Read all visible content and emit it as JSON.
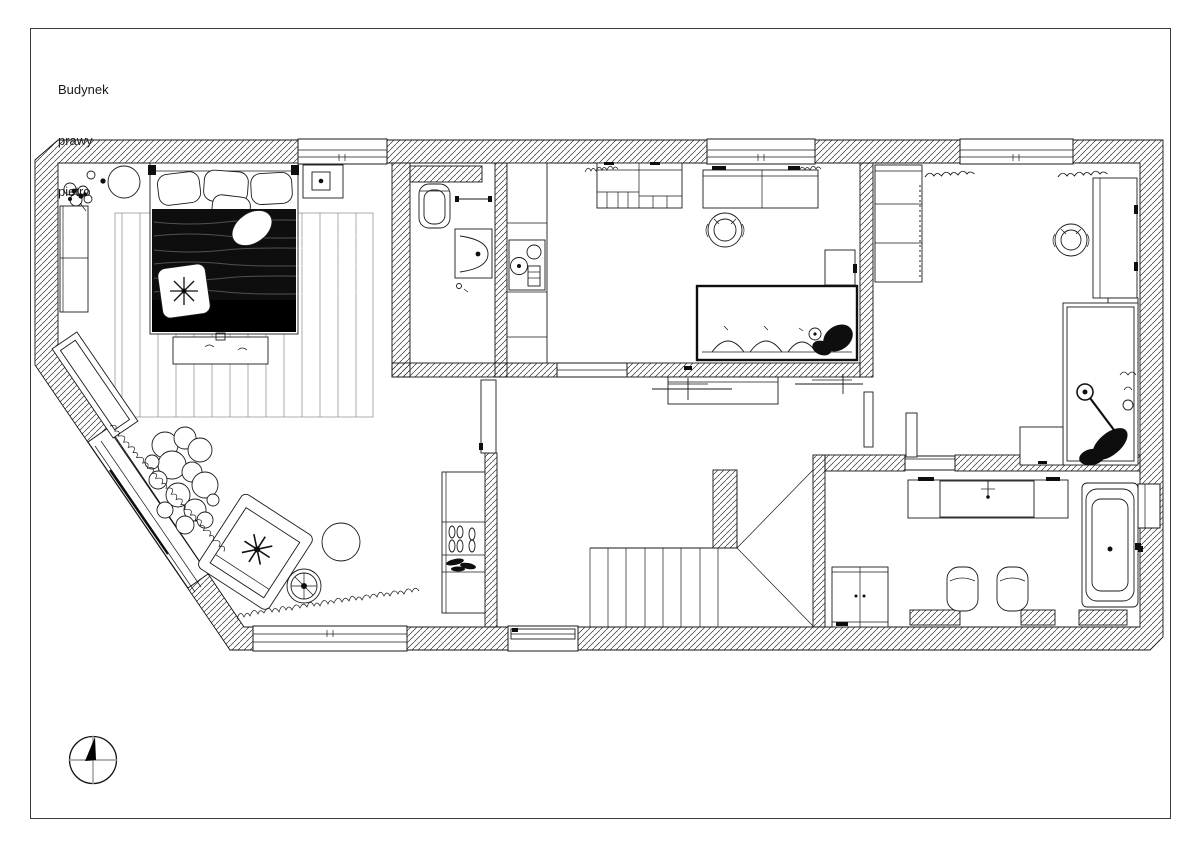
{
  "document": {
    "title_lines": [
      "Budynek",
      "prawy",
      "pietro"
    ]
  },
  "drawing": {
    "paper_color": "#ffffff",
    "line_color": "#1a1a1a",
    "wall_hatch": "diagonal-lines"
  },
  "compass": {
    "name": "north-arrow"
  },
  "plan_elements": [
    "double-bed",
    "bed-pillows",
    "duvet",
    "star-pillow",
    "rug",
    "bench",
    "nightstand-lamp",
    "wardrobe",
    "sideboard",
    "armchair",
    "round-table",
    "wheel-table",
    "plant-cluster",
    "grass-edge",
    "toilet",
    "washbasin",
    "towel-rail",
    "kitchenette-counter",
    "hob",
    "shelving-unit",
    "desk",
    "office-chair",
    "sofa",
    "sofa-cushions",
    "side-cabinet",
    "wardrobe-2",
    "desk-2",
    "office-chair-2",
    "lounger",
    "floor-lamp",
    "small-table",
    "stairs",
    "stairwell-void",
    "shoe-rack",
    "hall-cabinet",
    "hall-door",
    "sliding-door",
    "vanity-basin",
    "bathtub",
    "bathroom-cabinet",
    "stool-left",
    "stool-right",
    "wall-niche",
    "window-top-1",
    "window-top-2",
    "window-top-3",
    "window-bottom-1",
    "window-bottom-2",
    "diagonal-glazing"
  ]
}
